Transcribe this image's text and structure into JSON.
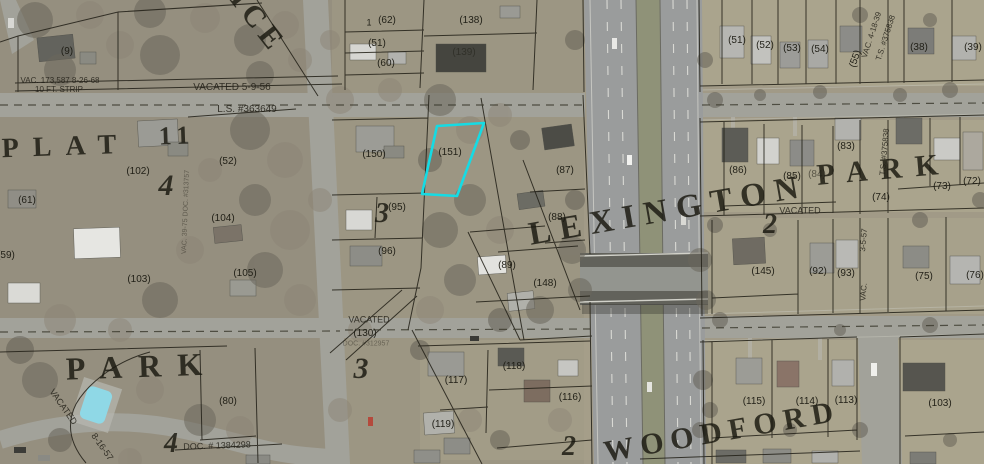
{
  "map": {
    "description": "Aerial parcel (plat) map with highlighted parcel",
    "plat_title": "PLAT 11",
    "highlighted_parcel": {
      "label": "(151)",
      "outline_color": "#15dbe4",
      "polygon": [
        [
          437,
          126
        ],
        [
          484,
          123
        ],
        [
          457,
          196
        ],
        [
          422,
          194
        ]
      ]
    },
    "colors": {
      "highlight": "#15dbe4",
      "parcel_line": "#211f16",
      "road": "#a2a29a",
      "ground": "#a19a87"
    },
    "street_labels": [
      {
        "t": "PLAT",
        "x": 66,
        "y": 147,
        "s": 28,
        "r": -2,
        "ls": 14
      },
      {
        "t": "11",
        "x": 177,
        "y": 136,
        "s": 26,
        "r": -2,
        "ls": 6
      },
      {
        "t": "4",
        "x": 166,
        "y": 186,
        "s": 30,
        "it": 1
      },
      {
        "t": "ICE",
        "x": 258,
        "y": 22,
        "s": 30,
        "r": 52,
        "ls": 6
      },
      {
        "t": "PARK",
        "x": 142,
        "y": 366,
        "s": 32,
        "r": -2,
        "ls": 16
      },
      {
        "t": "4",
        "x": 171,
        "y": 444,
        "s": 28,
        "it": 1
      },
      {
        "t": "3",
        "x": 382,
        "y": 214,
        "s": 28,
        "it": 1
      },
      {
        "t": "3",
        "x": 361,
        "y": 369,
        "s": 30,
        "it": 1
      },
      {
        "t": "2",
        "x": 770,
        "y": 225,
        "s": 28,
        "it": 1
      },
      {
        "t": "2",
        "x": 569,
        "y": 447,
        "s": 28,
        "it": 1
      },
      {
        "t": "LEXINGTON",
        "x": 668,
        "y": 211,
        "s": 33,
        "r": -10,
        "ls": 9
      },
      {
        "t": "WOODFORD",
        "x": 722,
        "y": 432,
        "s": 30,
        "r": -10,
        "ls": 7
      },
      {
        "t": "PARK",
        "x": 884,
        "y": 170,
        "s": 30,
        "r": -5,
        "ls": 13
      }
    ],
    "parcel_labels": [
      {
        "t": "(9)",
        "x": 67,
        "y": 52
      },
      {
        "t": "(61)",
        "x": 27,
        "y": 201
      },
      {
        "t": "(59)",
        "x": 6,
        "y": 256
      },
      {
        "t": "(102)",
        "x": 138,
        "y": 172
      },
      {
        "t": "(52)",
        "x": 228,
        "y": 162
      },
      {
        "t": "(104)",
        "x": 223,
        "y": 219
      },
      {
        "t": "(103)",
        "x": 139,
        "y": 280
      },
      {
        "t": "(105)",
        "x": 245,
        "y": 274
      },
      {
        "t": "(80)",
        "x": 228,
        "y": 402
      },
      {
        "t": "1",
        "x": 369,
        "y": 23,
        "s": 9
      },
      {
        "t": "(62)",
        "x": 387,
        "y": 21
      },
      {
        "t": "(51)",
        "x": 377,
        "y": 44
      },
      {
        "t": "(60)",
        "x": 386,
        "y": 64
      },
      {
        "t": "(138)",
        "x": 471,
        "y": 21
      },
      {
        "t": "(139)",
        "x": 464,
        "y": 53,
        "o": 0.5
      },
      {
        "t": "(150)",
        "x": 374,
        "y": 155
      },
      {
        "t": "(151)",
        "x": 450,
        "y": 153
      },
      {
        "t": "(95)",
        "x": 397,
        "y": 208
      },
      {
        "t": "(96)",
        "x": 387,
        "y": 252
      },
      {
        "t": "(87)",
        "x": 565,
        "y": 171
      },
      {
        "t": "(88)",
        "x": 557,
        "y": 218
      },
      {
        "t": "(89)",
        "x": 507,
        "y": 266
      },
      {
        "t": "(148)",
        "x": 545,
        "y": 284
      },
      {
        "t": "(117)",
        "x": 456,
        "y": 381
      },
      {
        "t": "(118)",
        "x": 514,
        "y": 367
      },
      {
        "t": "(116)",
        "x": 570,
        "y": 398
      },
      {
        "t": "(119)",
        "x": 443,
        "y": 425
      },
      {
        "t": "(130)",
        "x": 365,
        "y": 334
      },
      {
        "t": "(51)",
        "x": 737,
        "y": 41
      },
      {
        "t": "(52)",
        "x": 765,
        "y": 46
      },
      {
        "t": "(53)",
        "x": 792,
        "y": 49
      },
      {
        "t": "(54)",
        "x": 820,
        "y": 50
      },
      {
        "t": "(55)",
        "x": 856,
        "y": 59,
        "r": -70
      },
      {
        "t": "(38)",
        "x": 919,
        "y": 48
      },
      {
        "t": "(39)",
        "x": 973,
        "y": 48
      },
      {
        "t": "(86)",
        "x": 738,
        "y": 171
      },
      {
        "t": "(85)",
        "x": 792,
        "y": 177
      },
      {
        "t": "(84)",
        "x": 817,
        "y": 175,
        "o": 0.6
      },
      {
        "t": "(83)",
        "x": 846,
        "y": 147
      },
      {
        "t": "(74)",
        "x": 881,
        "y": 198
      },
      {
        "t": "(73)",
        "x": 942,
        "y": 187
      },
      {
        "t": "(72)",
        "x": 972,
        "y": 182
      },
      {
        "t": "(145)",
        "x": 763,
        "y": 272
      },
      {
        "t": "(92)",
        "x": 818,
        "y": 272
      },
      {
        "t": "(93)",
        "x": 846,
        "y": 274
      },
      {
        "t": "(75)",
        "x": 924,
        "y": 277
      },
      {
        "t": "(76)",
        "x": 975,
        "y": 276
      },
      {
        "t": "(115)",
        "x": 754,
        "y": 402
      },
      {
        "t": "(114)",
        "x": 807,
        "y": 402
      },
      {
        "t": "(113)",
        "x": 846,
        "y": 401
      },
      {
        "t": "(103)",
        "x": 940,
        "y": 404
      }
    ],
    "annotation_labels": [
      {
        "t": "VAC. 173,587 8-26-68",
        "x": 60,
        "y": 81,
        "s": 8
      },
      {
        "t": "10 FT. STRIP",
        "x": 59,
        "y": 90,
        "s": 8
      },
      {
        "t": "VACATED  5-9-56",
        "x": 232,
        "y": 88,
        "s": 10
      },
      {
        "t": "L.S. #363649",
        "x": 247,
        "y": 110,
        "s": 10
      },
      {
        "t": "VAC. 39-75 DOC. #313757",
        "x": 186,
        "y": 212,
        "s": 7,
        "r": -88,
        "o": 0.55
      },
      {
        "t": "VACATED",
        "x": 369,
        "y": 320,
        "s": 9
      },
      {
        "t": "DOC. #312957",
        "x": 366,
        "y": 344,
        "s": 7,
        "o": 0.5
      },
      {
        "t": "VACATED",
        "x": 800,
        "y": 211,
        "s": 9
      },
      {
        "t": "VAC. 4-18-39",
        "x": 872,
        "y": 35,
        "s": 8,
        "r": -72
      },
      {
        "t": "T.S. #375838",
        "x": 886,
        "y": 38,
        "s": 8,
        "r": -72
      },
      {
        "t": "T.S. #375838",
        "x": 885,
        "y": 152,
        "s": 8,
        "r": -85
      },
      {
        "t": "3-5-57",
        "x": 864,
        "y": 240,
        "s": 8,
        "r": -85
      },
      {
        "t": "VAC.",
        "x": 864,
        "y": 292,
        "s": 8,
        "r": -85
      },
      {
        "t": "VACATED",
        "x": 63,
        "y": 407,
        "s": 9,
        "r": 55
      },
      {
        "t": "8-16-57",
        "x": 102,
        "y": 447,
        "s": 9,
        "r": 55
      },
      {
        "t": "DOC. # 1384298",
        "x": 217,
        "y": 446,
        "s": 9,
        "r": -2
      }
    ]
  }
}
